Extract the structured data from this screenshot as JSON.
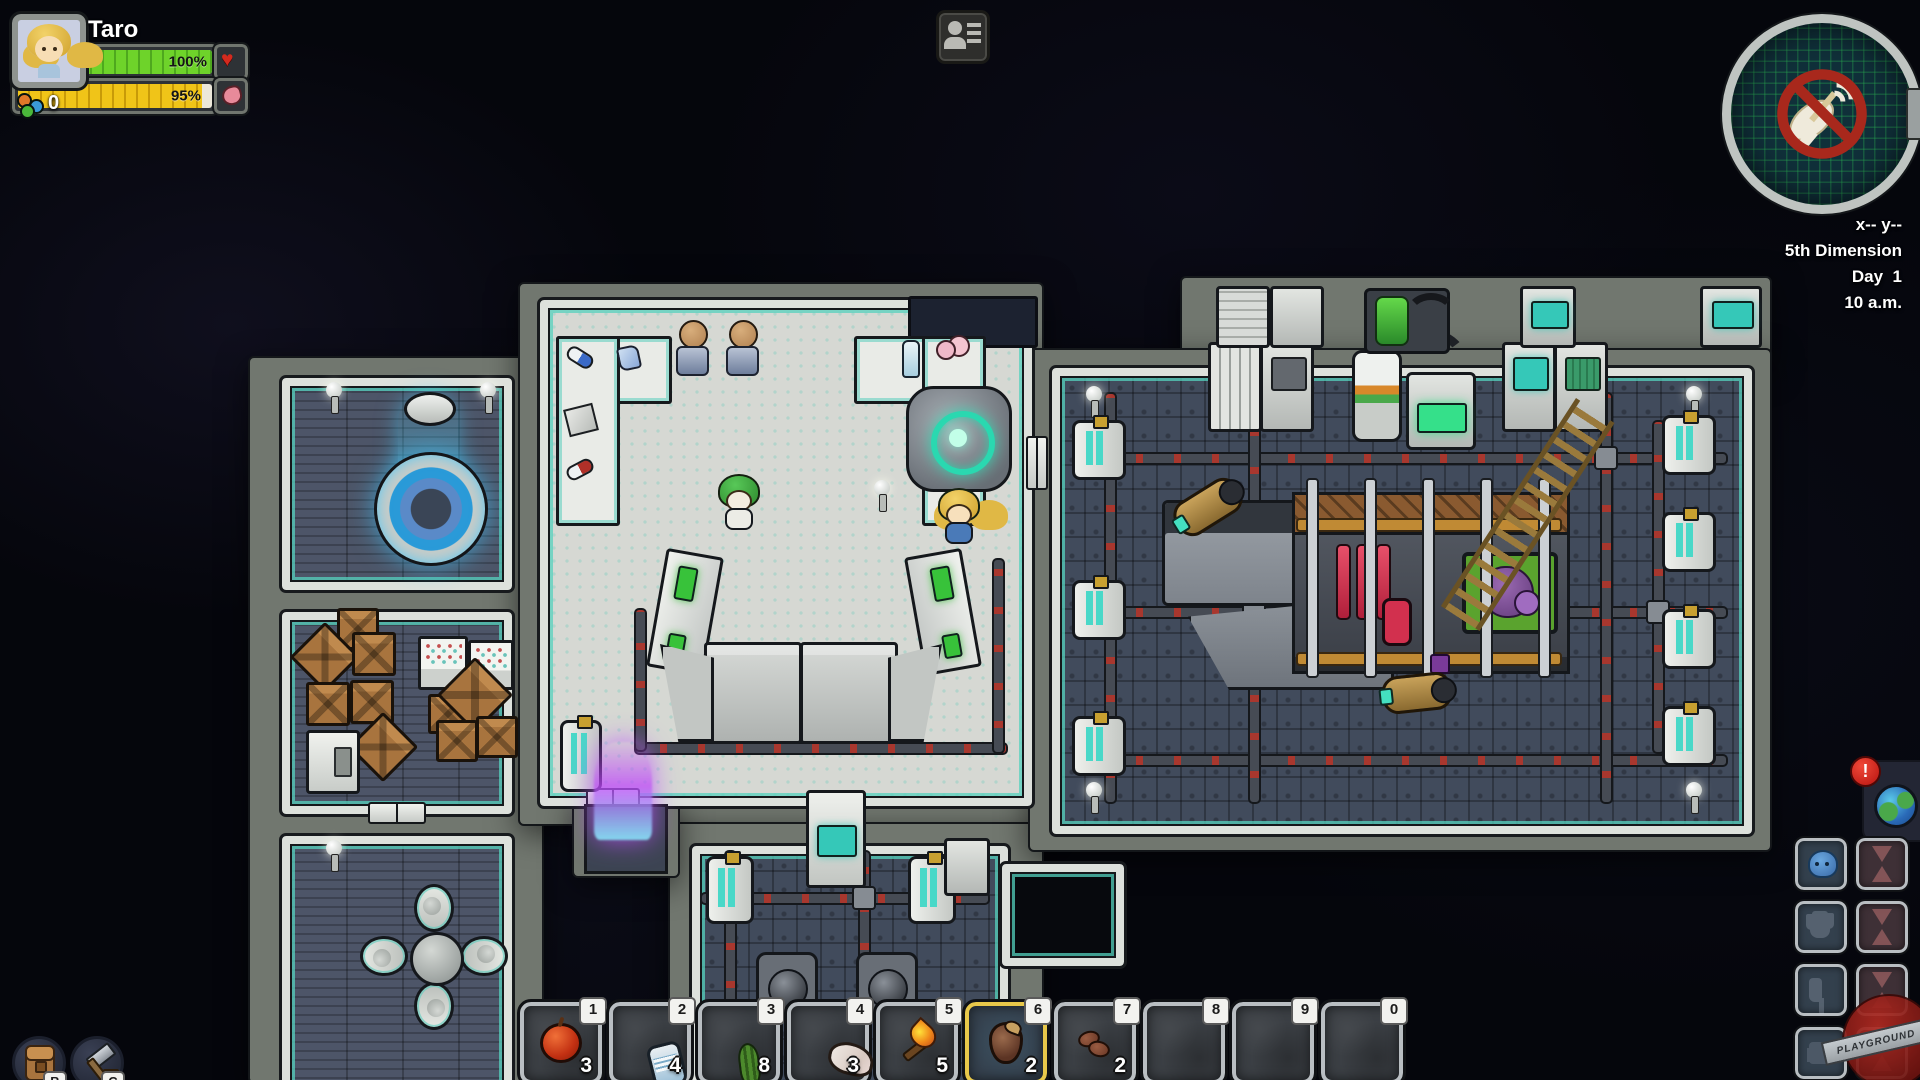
{
  "hud": {
    "player_panel": {
      "name": "Taro",
      "portrait": "blonde-girl-portrait",
      "health": {
        "value": "100%",
        "icon": "heart-icon",
        "color": "#62c62c"
      },
      "hunger": {
        "value": "95%",
        "icon": "stomach-icon",
        "color": "#e9b812"
      },
      "mood": {
        "count": "0",
        "icon": "mood-dots-icon"
      }
    },
    "top_bar": {
      "roster_button_icon": "crew-roster-icon"
    },
    "minimap": {
      "icon": "no-satellite-signal-icon"
    },
    "status_readout": {
      "coords": "x-- y--",
      "dimension": "5th Dimension",
      "day": "Day  1",
      "time": "10 a.m."
    },
    "world_button": {
      "icon": "planet-icon",
      "alert": "!"
    },
    "quickbar": {
      "selected_key": "6",
      "slots": [
        {
          "key": "1",
          "item": "apple",
          "count": "3"
        },
        {
          "key": "2",
          "item": "canned-food",
          "count": "4"
        },
        {
          "key": "3",
          "item": "vegetable",
          "count": "8"
        },
        {
          "key": "4",
          "item": "raw-meat",
          "count": "3"
        },
        {
          "key": "5",
          "item": "torch",
          "count": "5"
        },
        {
          "key": "6",
          "item": "seed",
          "count": "2"
        },
        {
          "key": "7",
          "item": "beans",
          "count": "2"
        },
        {
          "key": "8",
          "item": "",
          "count": ""
        },
        {
          "key": "9",
          "item": "",
          "count": ""
        },
        {
          "key": "0",
          "item": "",
          "count": ""
        }
      ]
    },
    "action_buttons": [
      {
        "label": "B",
        "icon": "backpack-icon",
        "action": "inventory"
      },
      {
        "label": "C",
        "icon": "hammer-icon",
        "action": "crafting"
      }
    ],
    "equipment_panel": {
      "rows": [
        {
          "gear": "helmet",
          "equipped": true,
          "timer": "hourglass"
        },
        {
          "gear": "gloves",
          "equipped": false,
          "timer": "hourglass"
        },
        {
          "gear": "boots",
          "equipped": false,
          "timer": "hourglass"
        },
        {
          "gear": "suit",
          "equipped": false,
          "timer": "hourglass"
        }
      ]
    },
    "watermark": "PLAYGROUND"
  },
  "world": {
    "rooms": [
      "teleporter-room",
      "storage-room",
      "lounge-room",
      "medbay-lab",
      "machine-room",
      "engine-room"
    ],
    "characters": [
      "green-haired-crew",
      "taro-blonde-crew"
    ],
    "objects": [
      "teleporter-pad",
      "cargo-crates",
      "supply-shelves",
      "refrigerator",
      "dining-table",
      "egg-chairs",
      "body-scanner",
      "armor-stands",
      "counter-medicines",
      "purple-plasma-fire",
      "ship-engine",
      "bio-reactor-window",
      "oxygen-generator",
      "generator-units",
      "catwalk",
      "torpedoes",
      "pipe-network",
      "void-pit",
      "ball-lamps"
    ]
  }
}
